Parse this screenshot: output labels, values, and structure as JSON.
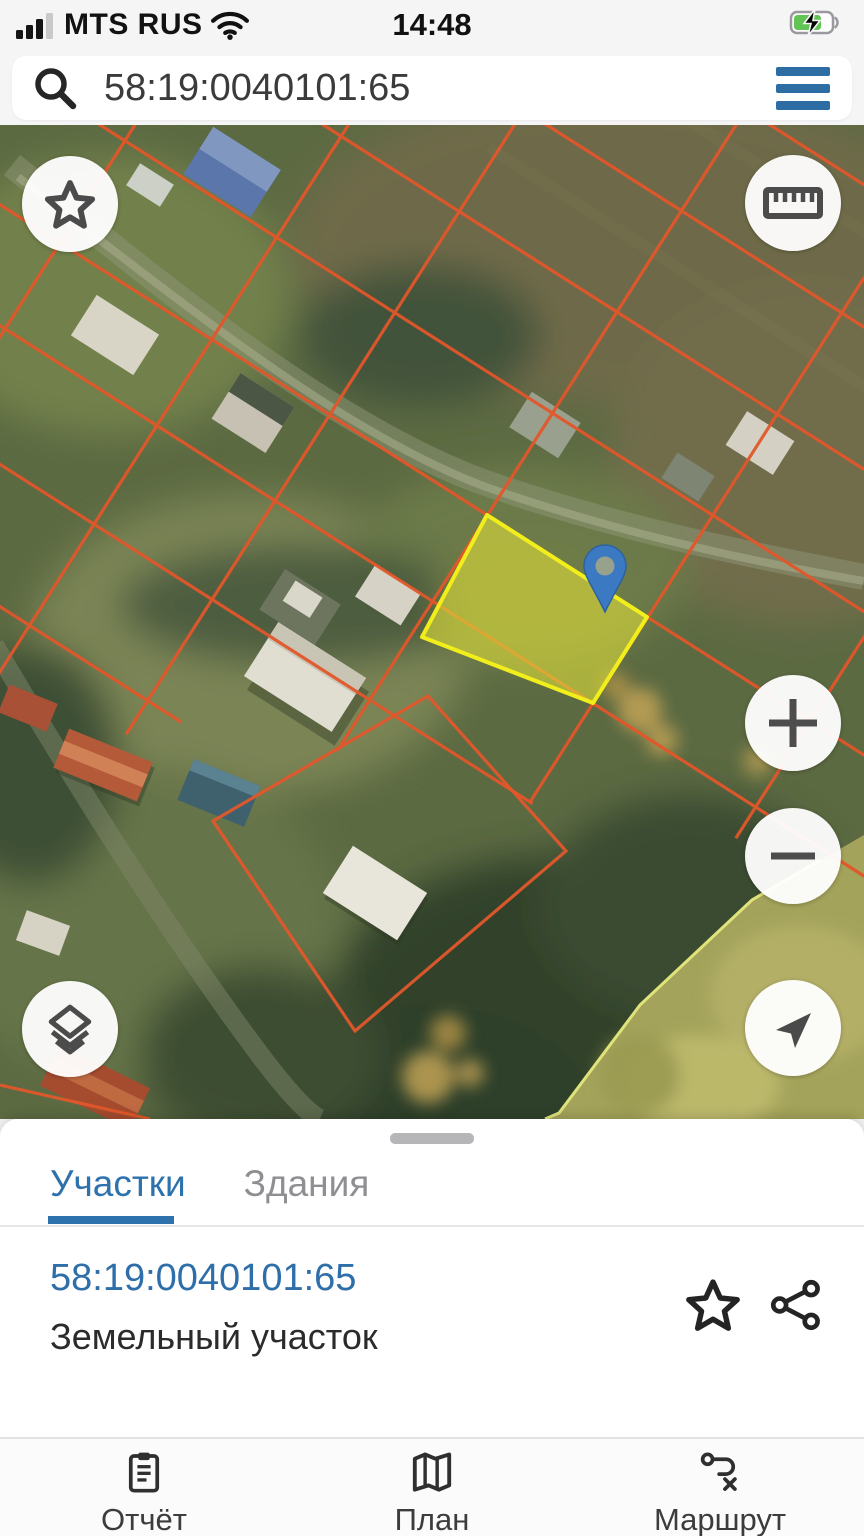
{
  "status_bar": {
    "carrier": "MTS RUS",
    "time": "14:48"
  },
  "search_bar": {
    "query": "58:19:0040101:65"
  },
  "map": {
    "selected_parcel": {
      "cadastral_number": "58:19:0040101:65",
      "fill_color": "#dede3a",
      "border_color": "#f2ee1c"
    },
    "parcel_line_color": "#e2572b",
    "pin_color": "#3b7ac2",
    "controls": [
      "favorite",
      "measure",
      "zoom-in",
      "zoom-out",
      "layers",
      "locate"
    ]
  },
  "bottom_sheet": {
    "tabs": [
      {
        "label": "Участки",
        "active": true
      },
      {
        "label": "Здания",
        "active": false
      }
    ],
    "result": {
      "cadastral_number": "58:19:0040101:65",
      "type_label": "Земельный участок"
    }
  },
  "nav_bar": {
    "items": [
      {
        "label": "Отчёт",
        "icon": "report-clipboard-icon"
      },
      {
        "label": "План",
        "icon": "plan-map-icon"
      },
      {
        "label": "Маршрут",
        "icon": "route-icon"
      }
    ]
  },
  "colors": {
    "accent_blue": "#2e72ad",
    "link_blue": "#2e6ea9",
    "parcel_red": "#e2572b",
    "selected_yellow": "#f2ee1c",
    "pin_blue": "#3b7ac2",
    "battery_green": "#61c454"
  }
}
